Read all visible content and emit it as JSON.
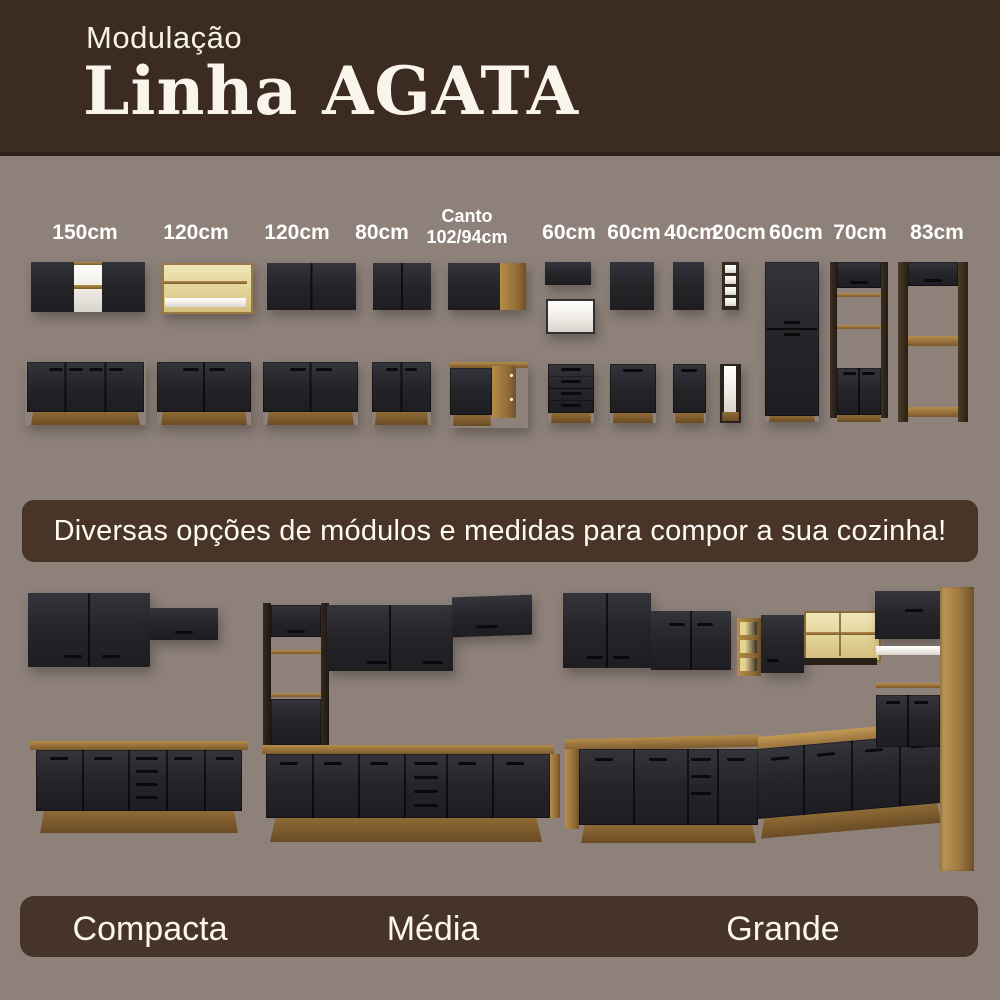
{
  "header": {
    "kicker": "Modulação",
    "title": "Linha AGATA"
  },
  "modules": [
    {
      "label": "150cm",
      "depicts": "wall cabinet with open niche + 3-door base cabinet"
    },
    {
      "label": "120cm",
      "depicts": "open wall cabinet with glass flap + 2-door base cabinet"
    },
    {
      "label": "120cm",
      "depicts": "2-door wall cabinet + 2-door base cabinet"
    },
    {
      "label": "80cm",
      "depicts": "2-door wall cabinet + 2-door base cabinet"
    },
    {
      "label": "Canto\n102/94cm",
      "depicts": "corner wall cabinet + corner base cabinet"
    },
    {
      "label": "60cm",
      "depicts": "flap wall cabinet and glass cabinet + 4-drawer base unit"
    },
    {
      "label": "60cm",
      "depicts": "1-door wall cabinet + 1-door base cabinet"
    },
    {
      "label": "40cm",
      "depicts": "1-door wall cabinet + 1-door base cabinet"
    },
    {
      "label": "20cm",
      "depicts": "open shelf tower + slim base unit"
    },
    {
      "label": "60cm",
      "depicts": "tall two-section pantry cabinet"
    },
    {
      "label": "70cm",
      "depicts": "tall oven tower with open shelves"
    },
    {
      "label": "83cm",
      "depicts": "tall refrigerator surround frame"
    }
  ],
  "banner": {
    "text": "Diversas opções de módulos e medidas para compor a sua cozinha!"
  },
  "kitchens": [
    {
      "name": "Compacta",
      "depicts": "straight kitchen with wall cabinets and 4-door base counter"
    },
    {
      "name": "Média",
      "depicts": "straight kitchen with tall open tower, wall cabinets and long base counter"
    },
    {
      "name": "Grande",
      "depicts": "L-shaped kitchen with niches, glass cabinet, fridge frame and corner counter"
    }
  ],
  "colors": {
    "header_bg": "#3b2b21",
    "page_bg": "#8d817a",
    "banner_bg": "#483528",
    "footer_bg": "#463428",
    "text_light": "#f8f3e9",
    "door_black": "#26262a",
    "wood": "#9a7440",
    "wood_light": "#c2a166",
    "interior_cream": "#e8dcaa"
  }
}
